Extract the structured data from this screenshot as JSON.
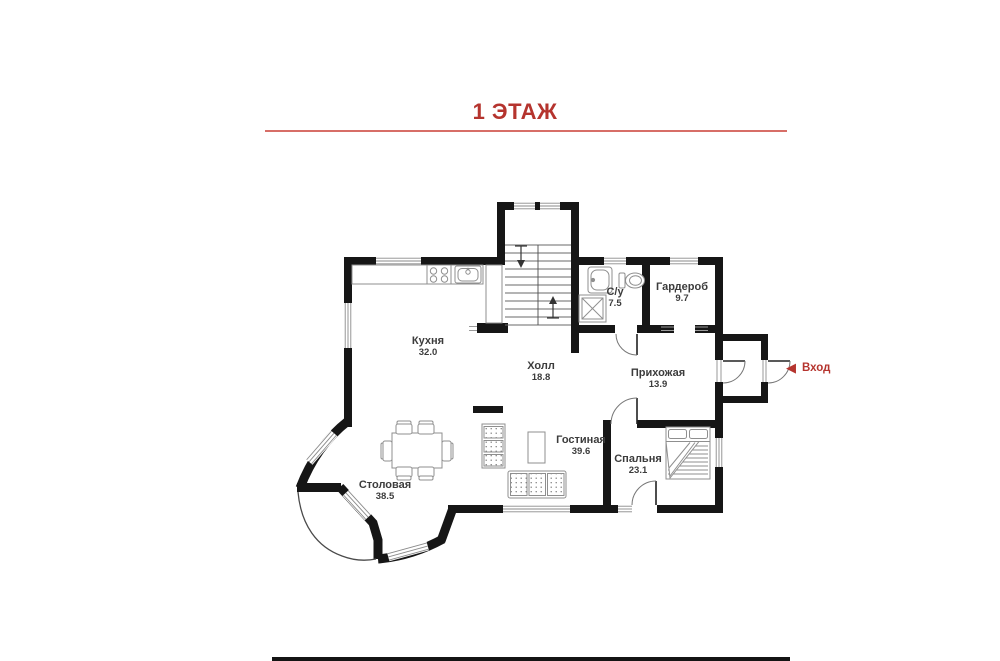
{
  "title": "1 ЭТАЖ",
  "entrance": {
    "label": "Вход"
  },
  "icons": {
    "entrance_arrow": "◀"
  },
  "rooms": [
    {
      "name": "Кухня",
      "area": "32.0"
    },
    {
      "name": "Холл",
      "area": "18.8"
    },
    {
      "name": "С/у",
      "area": "7.5"
    },
    {
      "name": "Гардероб",
      "area": "9.7"
    },
    {
      "name": "Прихожая",
      "area": "13.9"
    },
    {
      "name": "Гостиная",
      "area": "39.6"
    },
    {
      "name": "Спальня",
      "area": "23.1"
    },
    {
      "name": "Столовая",
      "area": "38.5"
    }
  ],
  "colors": {
    "accent_red": "#b5342e",
    "wall": "#161616",
    "furniture_line": "#8f8f8f"
  }
}
